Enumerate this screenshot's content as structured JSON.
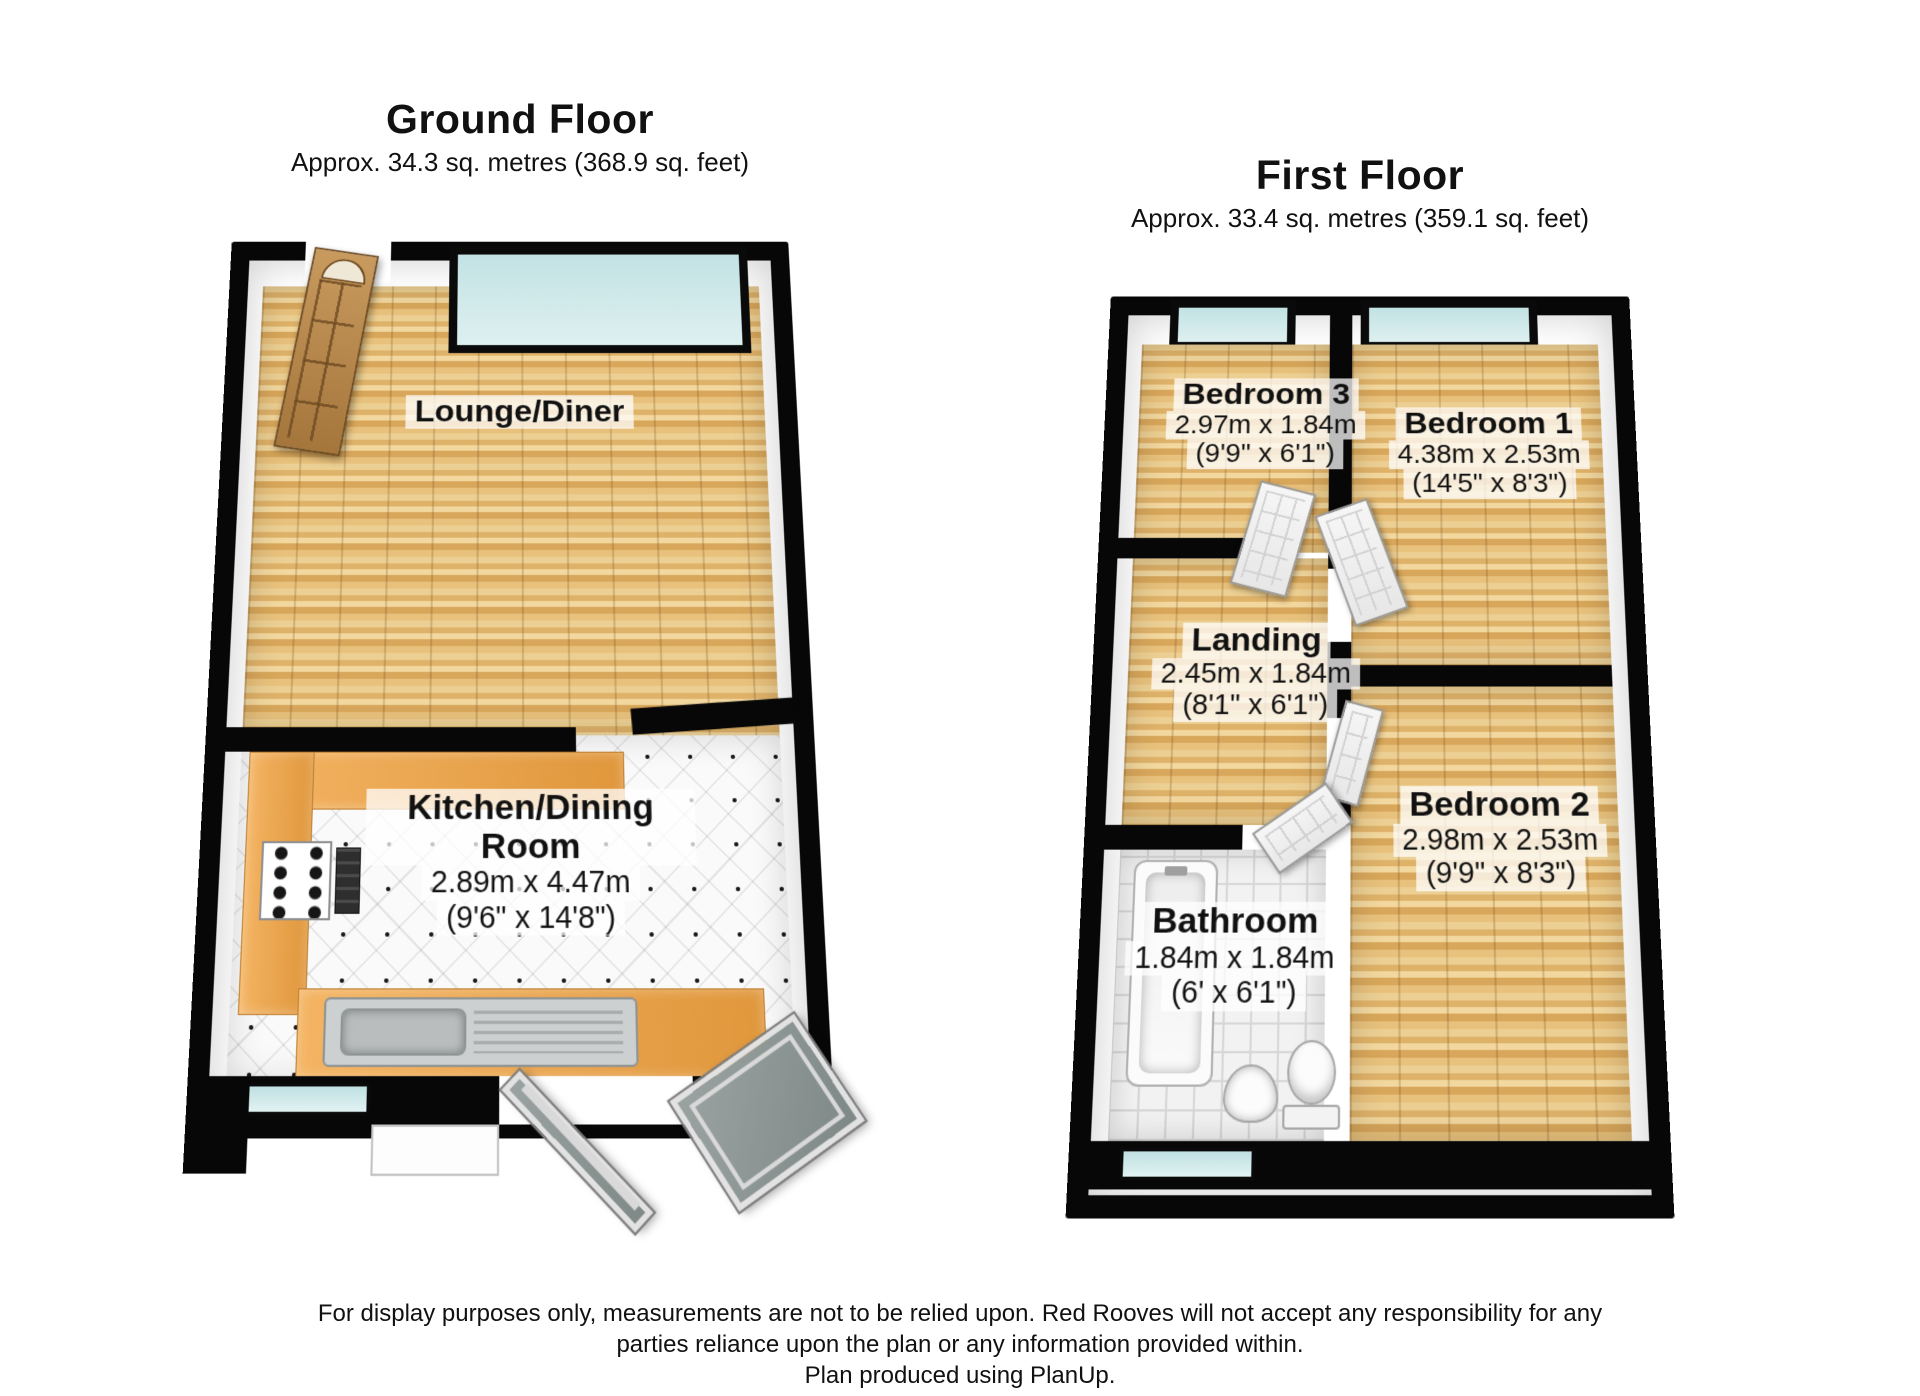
{
  "ground_floor": {
    "title": "Ground Floor",
    "area": "Approx. 34.3 sq. metres (368.9 sq. feet)",
    "rooms": {
      "lounge": {
        "name": "Lounge/Diner"
      },
      "kitchen": {
        "name": "Kitchen/Dining Room",
        "dims_metric": "2.89m x 4.47m",
        "dims_imperial": "(9'6\" x 14'8\")"
      }
    }
  },
  "first_floor": {
    "title": "First Floor",
    "area": "Approx. 33.4 sq. metres (359.1 sq. feet)",
    "rooms": {
      "bedroom3": {
        "name": "Bedroom 3",
        "dims_metric": "2.97m x 1.84m",
        "dims_imperial": "(9'9\" x 6'1\")"
      },
      "bedroom1": {
        "name": "Bedroom 1",
        "dims_metric": "4.38m x 2.53m",
        "dims_imperial": "(14'5\" x 8'3\")"
      },
      "landing": {
        "name": "Landing",
        "dims_metric": "2.45m x 1.84m",
        "dims_imperial": "(8'1\" x 6'1\")"
      },
      "bedroom2": {
        "name": "Bedroom 2",
        "dims_metric": "2.98m x 2.53m",
        "dims_imperial": "(9'9\" x 8'3\")"
      },
      "bathroom": {
        "name": "Bathroom",
        "dims_metric": "1.84m x 1.84m",
        "dims_imperial": "(6' x 6'1\")"
      }
    }
  },
  "footer": {
    "line1": "For display purposes only, measurements are not to be relied upon. Red Rooves will not accept any responsibility for any",
    "line2": "parties reliance upon the plan or any information provided within.",
    "line3": "Plan produced using PlanUp."
  },
  "colors": {
    "wall": "#070707",
    "wood_floor": "#e3b872",
    "tile_floor": "#fafafa",
    "window_glass": "#cde8e8",
    "counter": "#eca84e",
    "label_bg": "rgba(255,255,255,0.74)"
  }
}
